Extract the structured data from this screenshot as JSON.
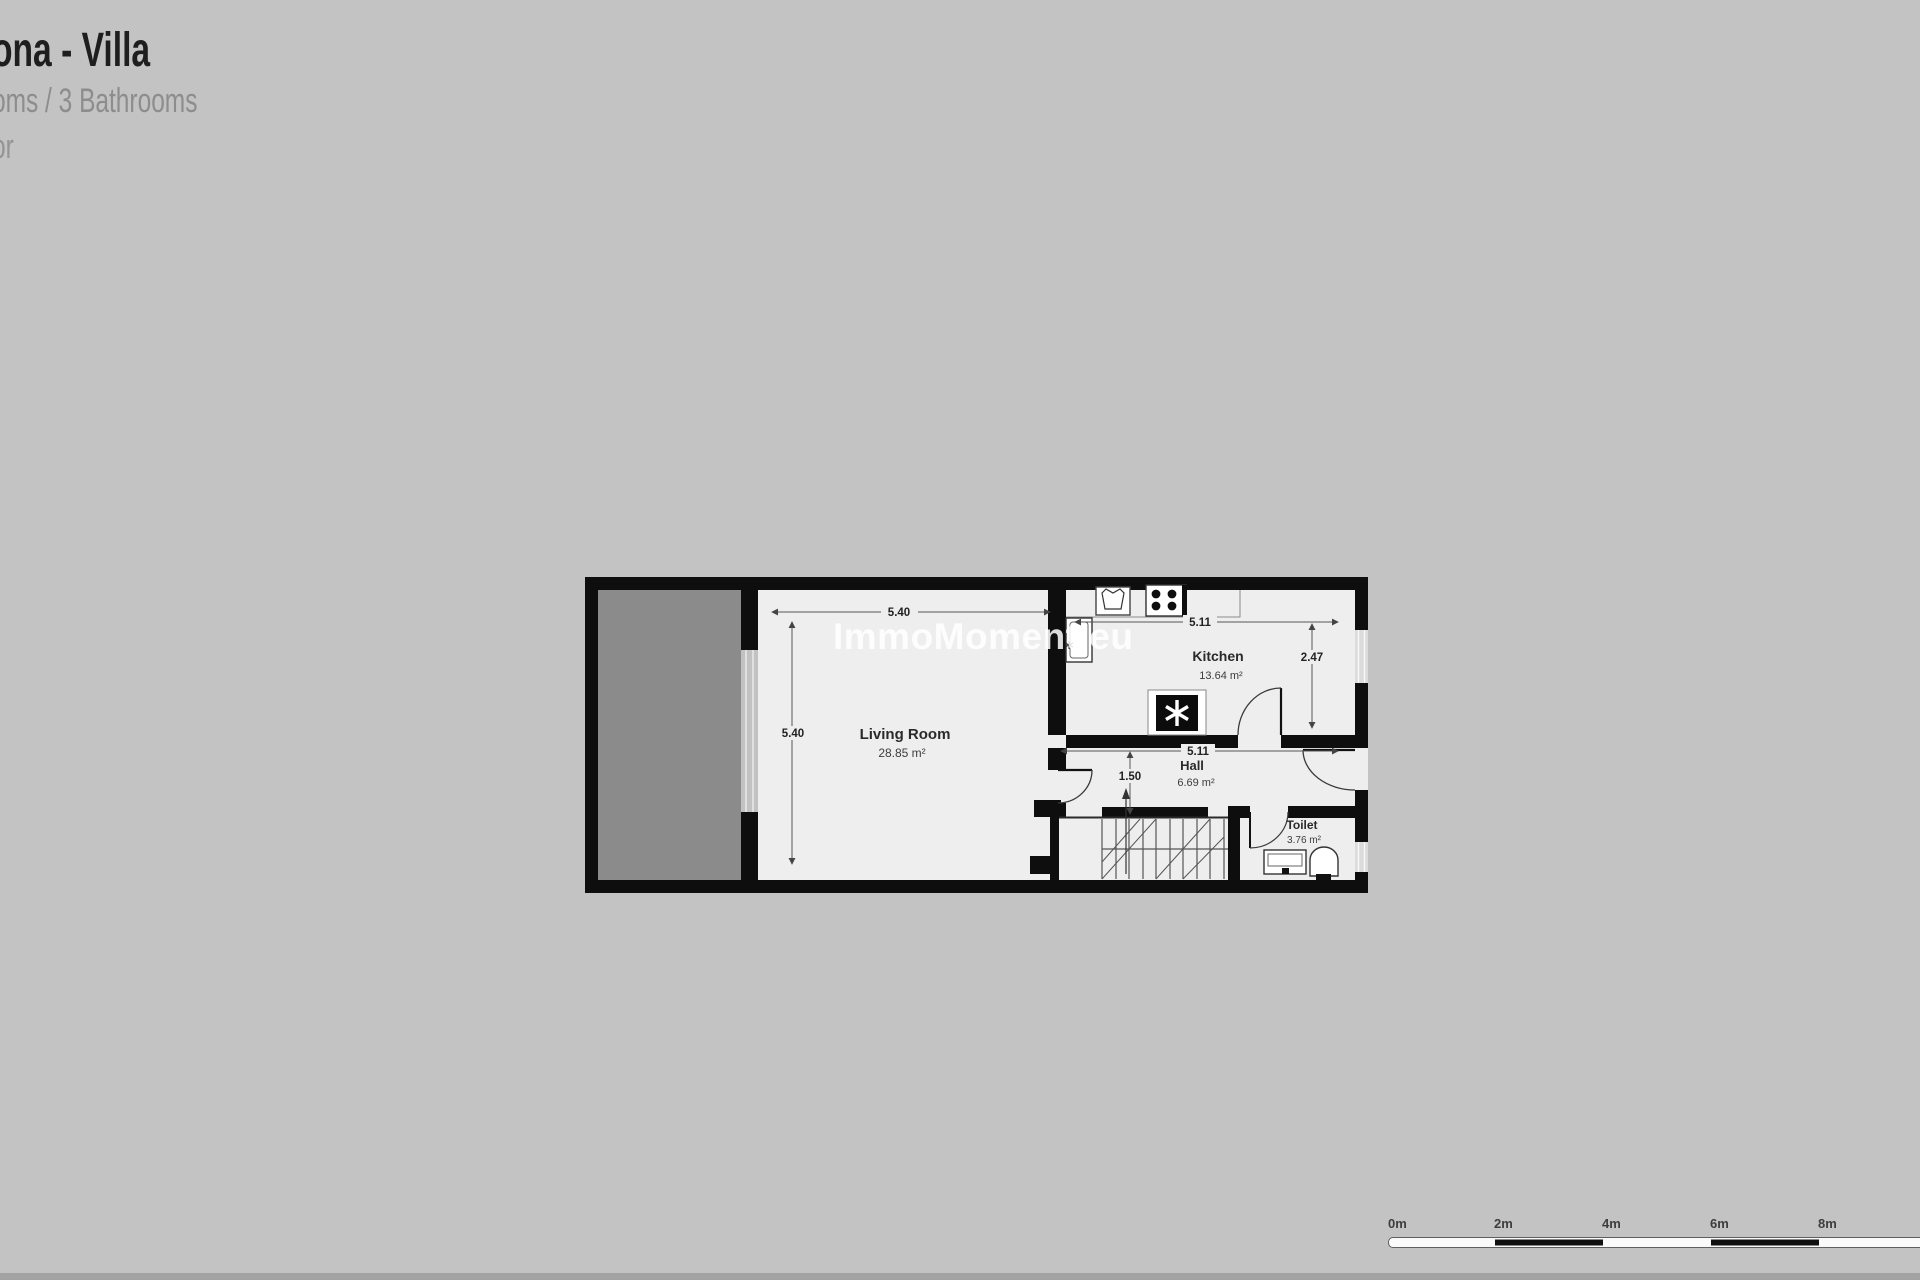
{
  "page": {
    "background": "#c3c3c3"
  },
  "header": {
    "title": "ona - Villa",
    "subtitle": "oms / 3 Bathrooms",
    "floor_line": "or"
  },
  "watermark": "ImmoMoment.eu",
  "floorplan": {
    "rooms": {
      "living_room": {
        "name": "Living Room",
        "area": "28.85 m²",
        "dim_width": "5.40",
        "dim_height": "5.40"
      },
      "kitchen": {
        "name": "Kitchen",
        "area": "13.64 m²",
        "dim_width": "5.11",
        "dim_height": "2.47"
      },
      "hall": {
        "name": "Hall",
        "area": "6.69 m²",
        "dim_width": "5.11",
        "dim_height": "1.50"
      },
      "toilet": {
        "name": "Toilet",
        "area": "3.76 m²"
      }
    },
    "colors": {
      "wall": "#0e0e0e",
      "floor": "#efeeee",
      "terrace": "#8b8b8b",
      "window": "#dcdcdc"
    }
  },
  "scale_bar": {
    "labels": [
      "0m",
      "2m",
      "4m",
      "6m",
      "8m"
    ],
    "segment_meters": 2
  }
}
